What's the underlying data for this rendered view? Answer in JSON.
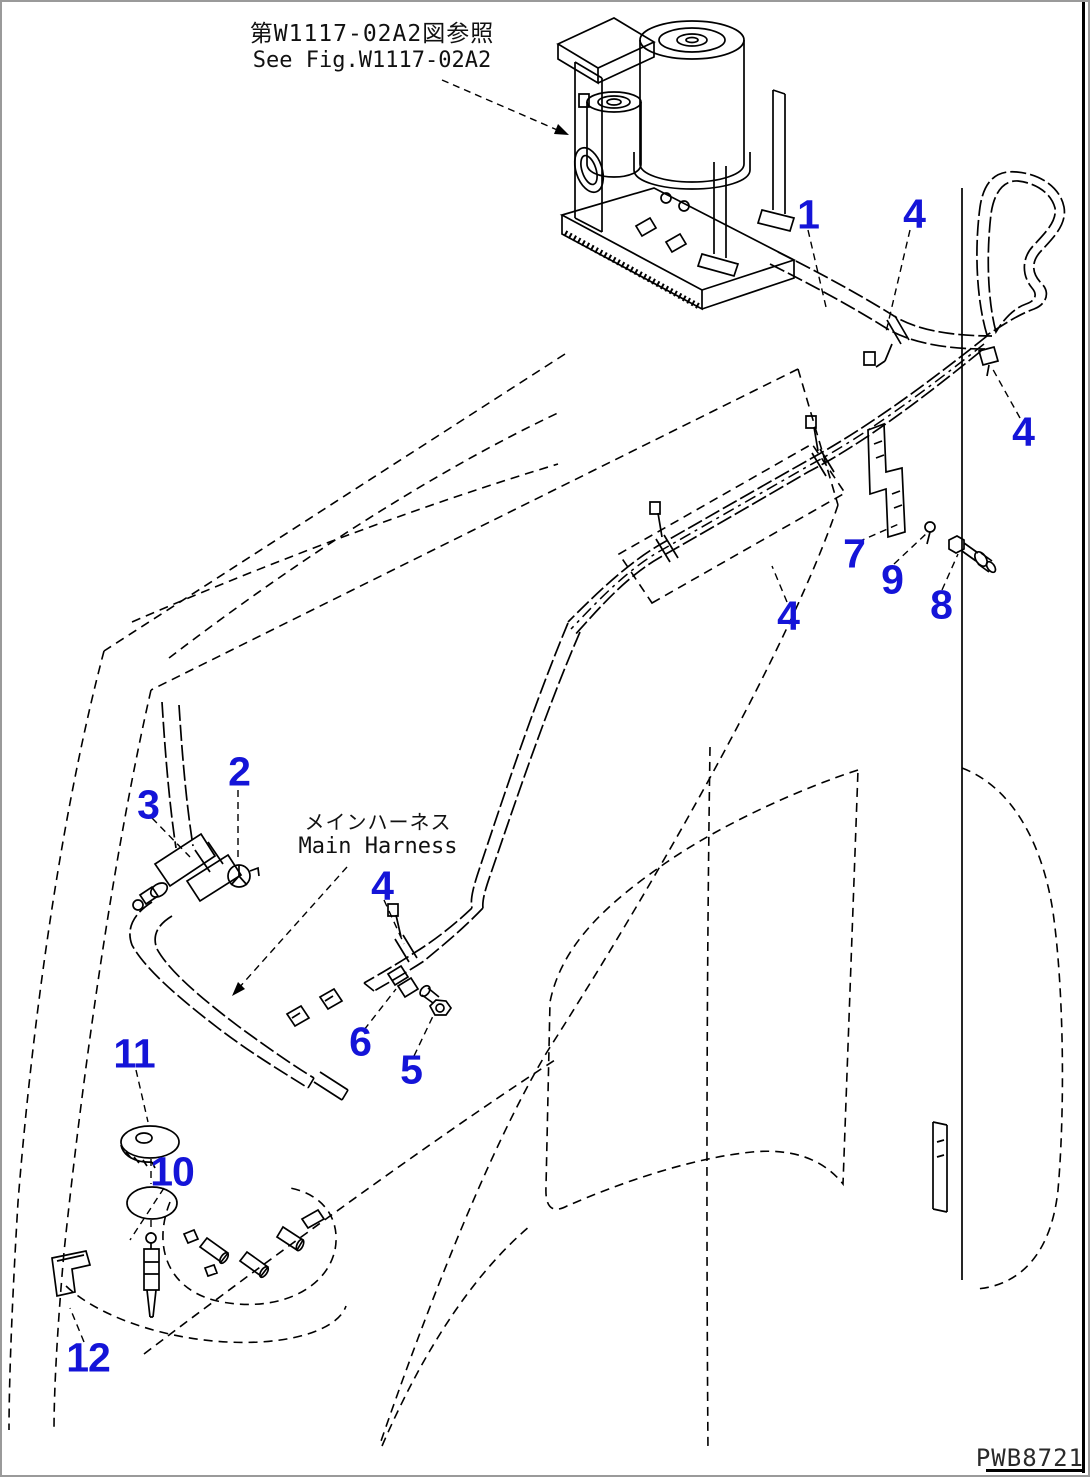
{
  "page": {
    "background": "#ffffff",
    "outer_border_color": "#9a9a9a",
    "frame_color": "#000000",
    "line_color": "#000000",
    "callout_color": "#1414d8"
  },
  "reference_note": {
    "jp": "第W1117-02A2図参照",
    "en": "See Fig.W1117-02A2"
  },
  "harness_label": {
    "jp": "メインハーネス",
    "en": "Main Harness"
  },
  "drawing_code": "PWB8721",
  "callouts": [
    {
      "label": "1",
      "x": 806,
      "y": 213
    },
    {
      "label": "4",
      "x": 912,
      "y": 212
    },
    {
      "label": "4",
      "x": 1021,
      "y": 430
    },
    {
      "label": "7",
      "x": 852,
      "y": 552
    },
    {
      "label": "9",
      "x": 890,
      "y": 578
    },
    {
      "label": "8",
      "x": 939,
      "y": 603
    },
    {
      "label": "4",
      "x": 786,
      "y": 614
    },
    {
      "label": "2",
      "x": 237,
      "y": 770
    },
    {
      "label": "3",
      "x": 146,
      "y": 803
    },
    {
      "label": "4",
      "x": 380,
      "y": 884
    },
    {
      "label": "6",
      "x": 358,
      "y": 1040
    },
    {
      "label": "5",
      "x": 409,
      "y": 1068
    },
    {
      "label": "11",
      "x": 132,
      "y": 1052
    },
    {
      "label": "10",
      "x": 170,
      "y": 1170
    },
    {
      "label": "12",
      "x": 86,
      "y": 1356
    }
  ]
}
